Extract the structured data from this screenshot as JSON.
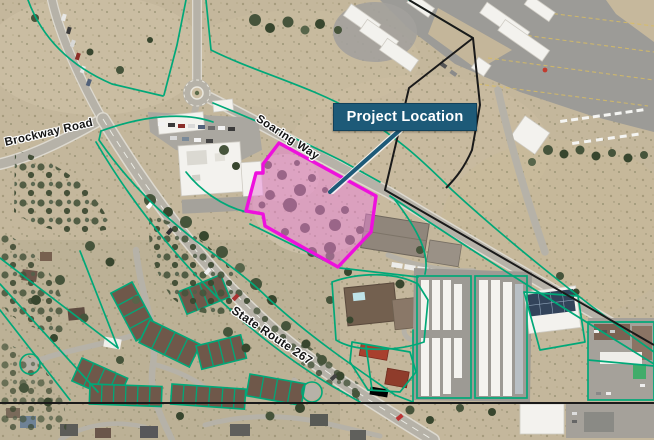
{
  "map": {
    "callout": {
      "label": "Project Location"
    },
    "road_labels": [
      {
        "id": "brockway-road",
        "label": "Brockway Road"
      },
      {
        "id": "soaring-way",
        "label": "Soaring Way"
      },
      {
        "id": "state-route-267",
        "label": "State Route 267"
      }
    ],
    "colors": {
      "project_site_outline": "#ee10dd",
      "project_site_fill": "#e87fd4",
      "parcel_line": "#00a878",
      "boundary_line": "#1a1a1a",
      "callout_background": "#1d5a78",
      "callout_text": "#ffffff"
    }
  }
}
